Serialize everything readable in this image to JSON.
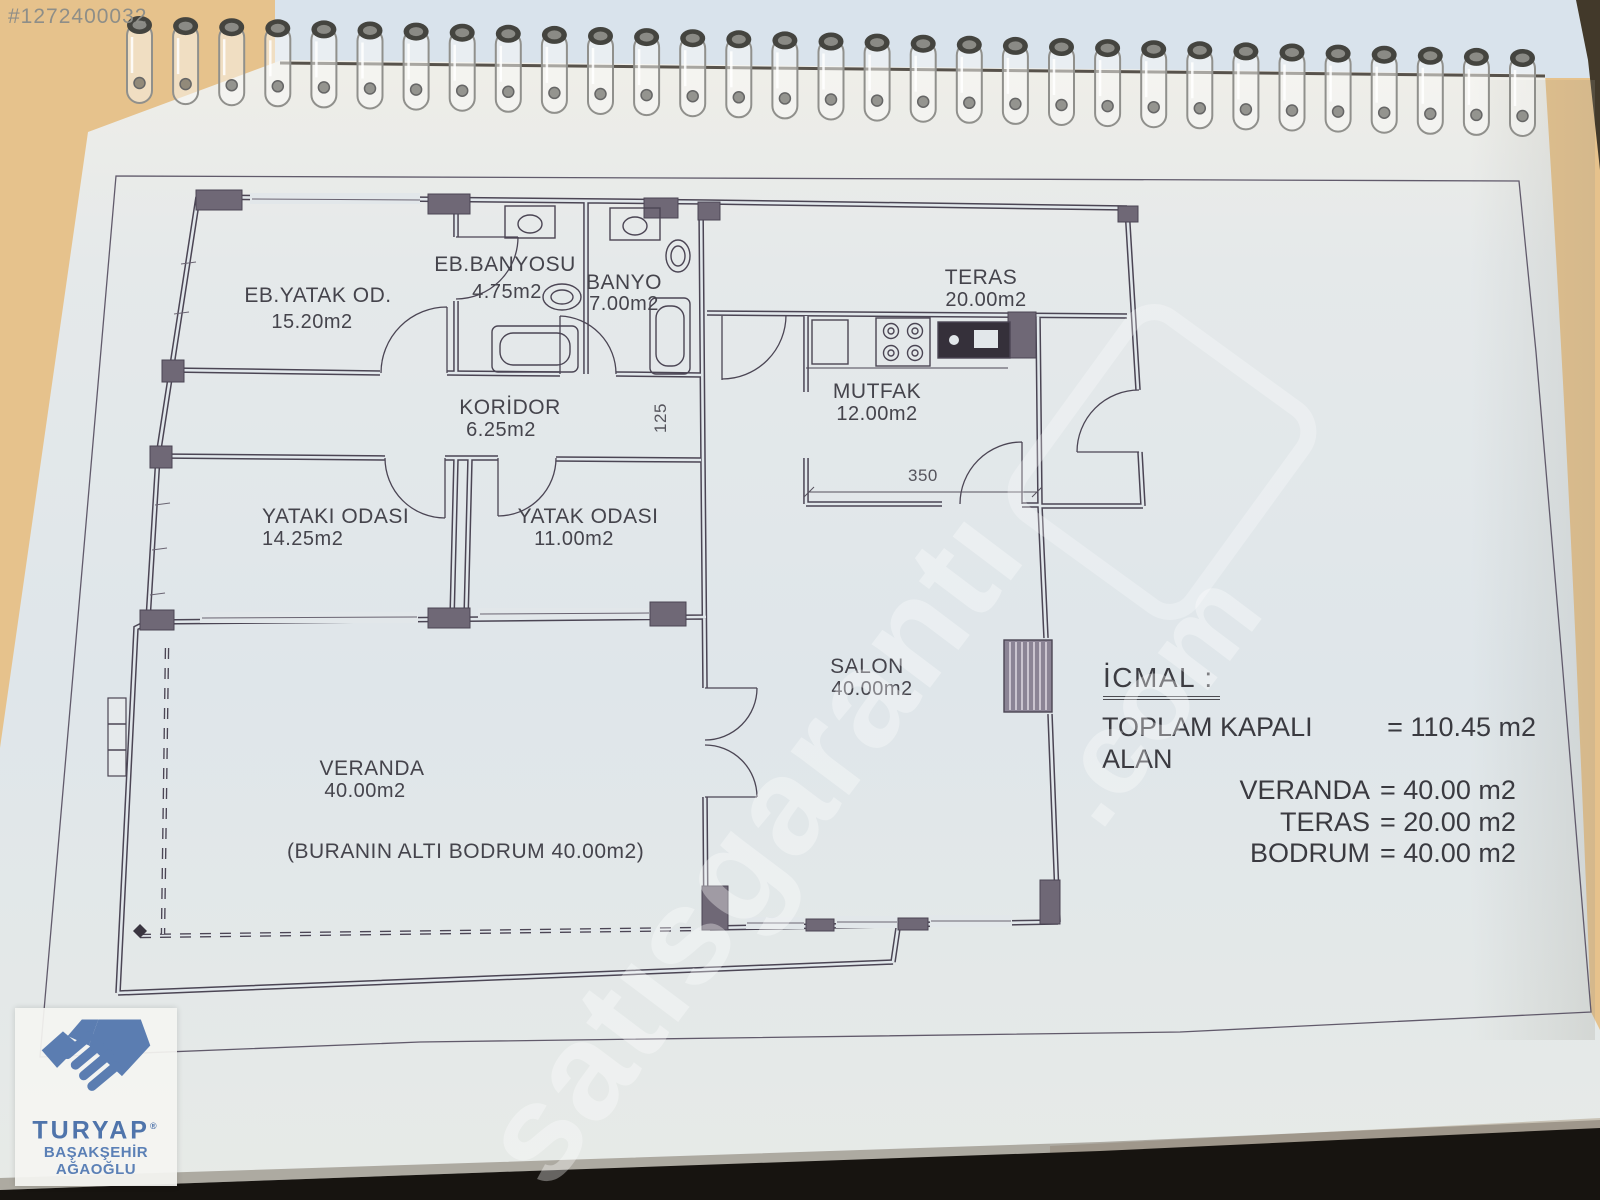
{
  "photo_id": "#1272400032",
  "watermark": {
    "word": "satısgarantı",
    "com": ".com"
  },
  "plan": {
    "rooms": {
      "eb_yatak": {
        "name": "EB.YATAK OD.",
        "area": "15.20m2"
      },
      "eb_banyosu": {
        "name": "EB.BANYOSU",
        "area": "4.75m2"
      },
      "banyo": {
        "name": "BANYO",
        "area": "7.00m2"
      },
      "teras": {
        "name": "TERAS",
        "area": "20.00m2"
      },
      "koridor": {
        "name": "KORİDOR",
        "area": "6.25m2"
      },
      "mutfak": {
        "name": "MUTFAK",
        "area": "12.00m2"
      },
      "yataki": {
        "name": "YATAKI ODASI",
        "area": "14.25m2"
      },
      "yatak": {
        "name": "YATAK ODASI",
        "area": "11.00m2"
      },
      "salon": {
        "name": "SALON",
        "area": "40.00m2"
      },
      "veranda": {
        "name": "VERANDA",
        "area": "40.00m2"
      }
    },
    "basement_note": "(BURANIN ALTI BODRUM  40.00m2)",
    "dimensions": {
      "mutfak_width": "350",
      "koridor_depth": "125"
    },
    "summary": {
      "title": "İCMAL :",
      "lines": {
        "l1": {
          "label": "TOPLAM KAPALI ALAN",
          "value": "= 110.45 m2"
        },
        "l2": {
          "label": "VERANDA",
          "value": "= 40.00 m2"
        },
        "l3": {
          "label": "TERAS",
          "value": "= 20.00 m2"
        },
        "l4": {
          "label": "BODRUM",
          "value": "= 40.00 m2"
        }
      }
    }
  },
  "agency": {
    "name": "TURYAP",
    "reg": "®",
    "branch": "BAŞAKŞEHİR AĞAOĞLU"
  },
  "colors": {
    "wall": "#4b4554",
    "paper": "#e2e7ea",
    "backdrop": "#e6c28c",
    "accent_blue": "#4f74ab",
    "shadow": "#171410"
  }
}
